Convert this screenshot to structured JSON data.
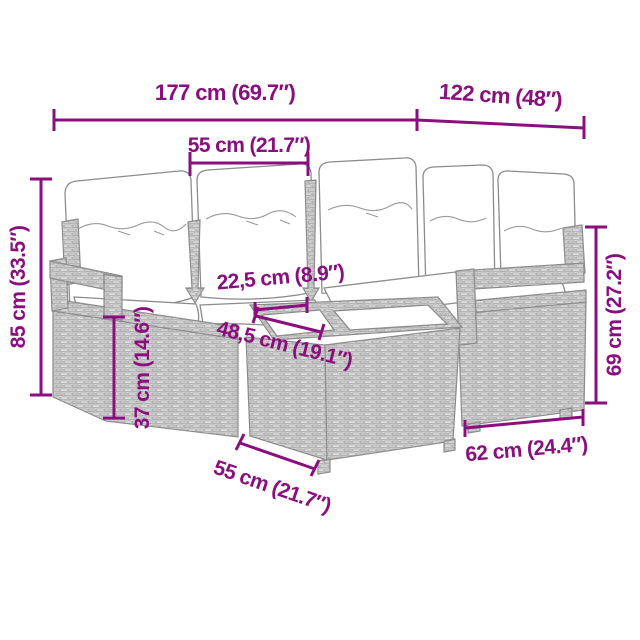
{
  "diagram": {
    "depicts": "L-shaped poly rattan garden corner sofa set with white cushions and a glass-top wicker table, annotated with dimensions"
  },
  "colors": {
    "dimension": "#8B0E7F",
    "outline": "#8C8C8C",
    "wicker_fill": "#ECECEC",
    "cushion": "#FFFFFF",
    "background": "#FFFFFF"
  },
  "dimensions": {
    "total_width": "177 cm (69.7″)",
    "total_depth": "122 cm (48″)",
    "seat_width": "55 cm (21.7″)",
    "overall_height": "85 cm (33.5″)",
    "seat_height": "37 cm (14.6″)",
    "table_offset": "22,5 cm (8.9″)",
    "table_top_width": "48,5 cm (19.1″)",
    "armrest_height": "69 cm (27.2″)",
    "module_depth": "62 cm (24.4″)",
    "table_side": "55 cm (21.7″)"
  }
}
